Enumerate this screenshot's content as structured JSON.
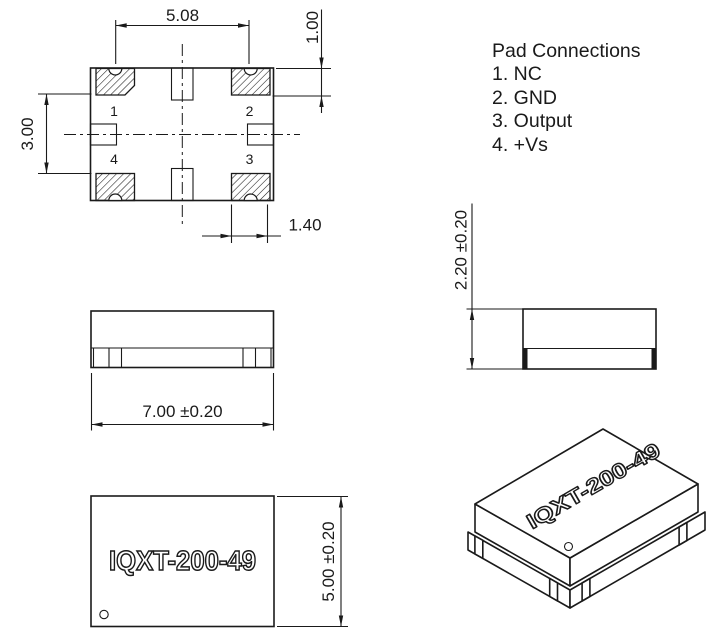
{
  "drawing": {
    "pad_connections": {
      "title": "Pad Connections",
      "items": [
        "1. NC",
        "2. GND",
        "3. Output",
        "4. +Vs"
      ]
    },
    "top_view": {
      "pad1": "1",
      "pad2": "2",
      "pad3": "3",
      "pad4": "4",
      "dim_pad_pitch": "5.08",
      "dim_pad_length": "1.00",
      "dim_pad_span": "3.00",
      "dim_pad_width": "1.40"
    },
    "front_view": {
      "dim_body_width": "7.00 ±0.20"
    },
    "side_view": {
      "dim_body_height": "2.20 ±0.20"
    },
    "marking_view": {
      "part_number": "IQXT-200-49",
      "dim_body_depth": "5.00 ±0.20"
    },
    "iso_view": {
      "part_number": "IQXT-200-49"
    },
    "colors": {
      "line": "#1a1a1a",
      "background": "#ffffff"
    }
  }
}
